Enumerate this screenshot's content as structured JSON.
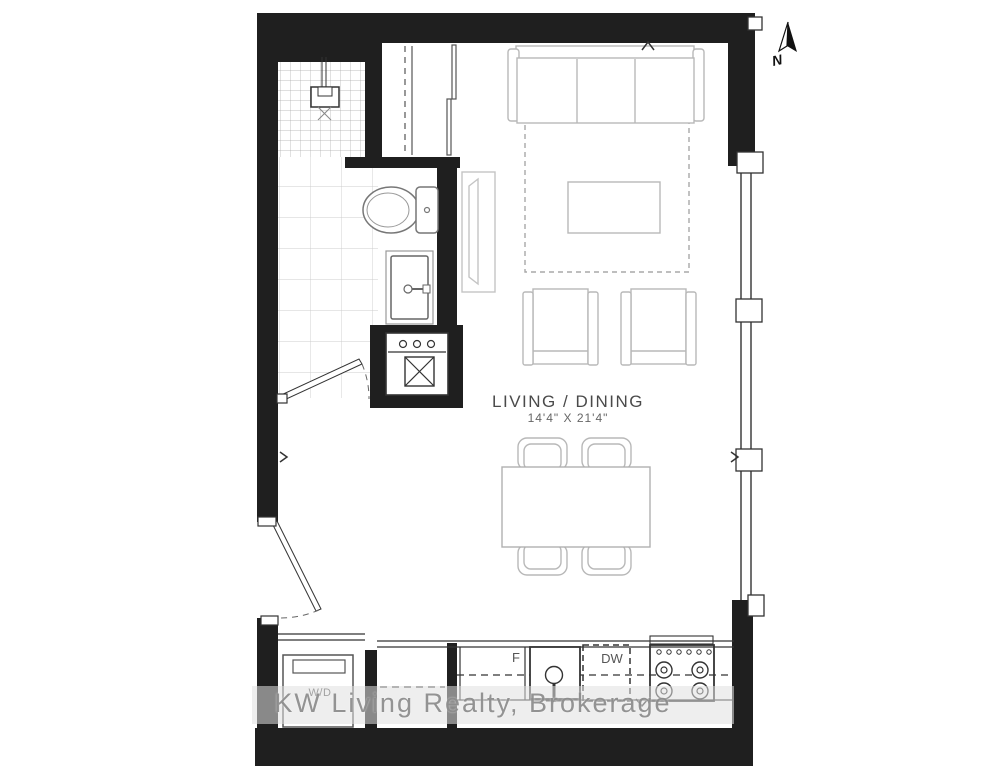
{
  "plan": {
    "room": {
      "name": "LIVING / DINING",
      "dimensions": "14'4\" X 21'4\""
    },
    "kitchen": {
      "fridge_label": "F",
      "dishwasher_label": "DW"
    },
    "laundry": {
      "washer_dryer_label": "W/D"
    },
    "compass": {
      "north_label": "N"
    },
    "watermark": {
      "text": "KW Living Realty, Brokerage"
    },
    "colors": {
      "wall": "#1f1f1f",
      "furniture": "#b8b8b8",
      "fixture": "#666666",
      "kitchen_line": "#333333",
      "tile_small": "#aaaaaa",
      "tile_large": "#cccccc",
      "watermark_text": "#8a8a8a"
    }
  }
}
